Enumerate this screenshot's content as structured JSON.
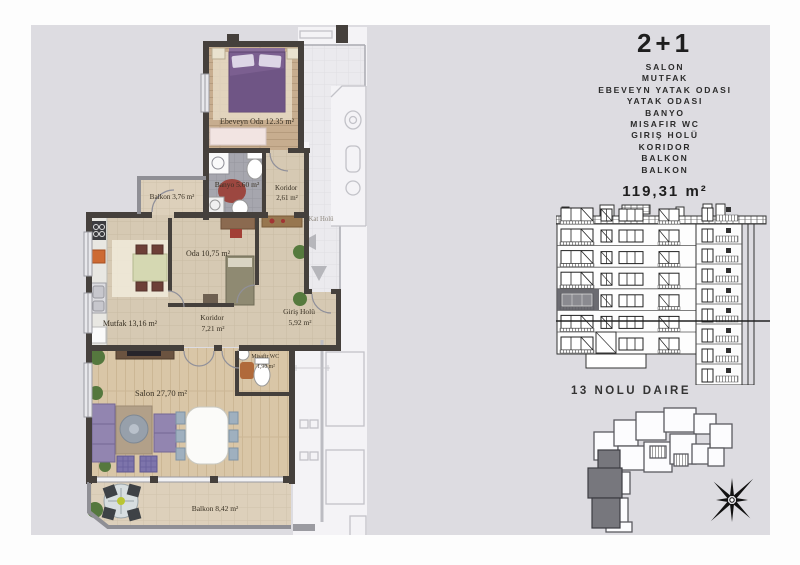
{
  "summary": {
    "title": "2+1",
    "room_list": [
      "SALON",
      "MUTFAK",
      "EBEVEYN YATAK ODASI",
      "YATAK ODASI",
      "BANYO",
      "MISAFIR WC",
      "GIRIŞ HOLÜ",
      "KORIDOR",
      "BALKON",
      "BALKON"
    ],
    "total_area": "119,31 m²"
  },
  "unit": {
    "label": "13 NOLU DAIRE"
  },
  "plan": {
    "rooms": {
      "ebeveyn": {
        "label": "Ebeveyn Oda 12.35 m²"
      },
      "banyo": {
        "label": "Banyo 5.60 m²"
      },
      "koridor_ust": {
        "name": "Koridor",
        "area": "2,61 m²"
      },
      "balkon_ust": {
        "label": "Balkon 3,76 m²"
      },
      "kat_holu": {
        "label": "Kat Holü"
      },
      "oda": {
        "label": "Oda 10,75 m²"
      },
      "mutfak": {
        "label": "Mutfak 13,16 m²"
      },
      "koridor_alt": {
        "name": "Koridor",
        "area": "7,21 m²"
      },
      "giris_holu": {
        "name": "Giriş Holü",
        "area": "5,92 m²"
      },
      "misafir_wc": {
        "name": "Misafir WC",
        "area": "1,90 m²"
      },
      "salon": {
        "label": "Salon 27,70 m²"
      },
      "balkon_alt": {
        "label": "Balkon 8,42 m²"
      }
    }
  },
  "colors": {
    "panel_bg": "#dddce1",
    "wall": "#45403c",
    "floor_wood": "#c7ad8f",
    "floor_tile_beige": "#d6c9b3",
    "floor_tile_gray": "#a6a6ae",
    "bed": "#7b5f90",
    "sofa": "#9285b0",
    "highlighted_unit": "#606066"
  }
}
